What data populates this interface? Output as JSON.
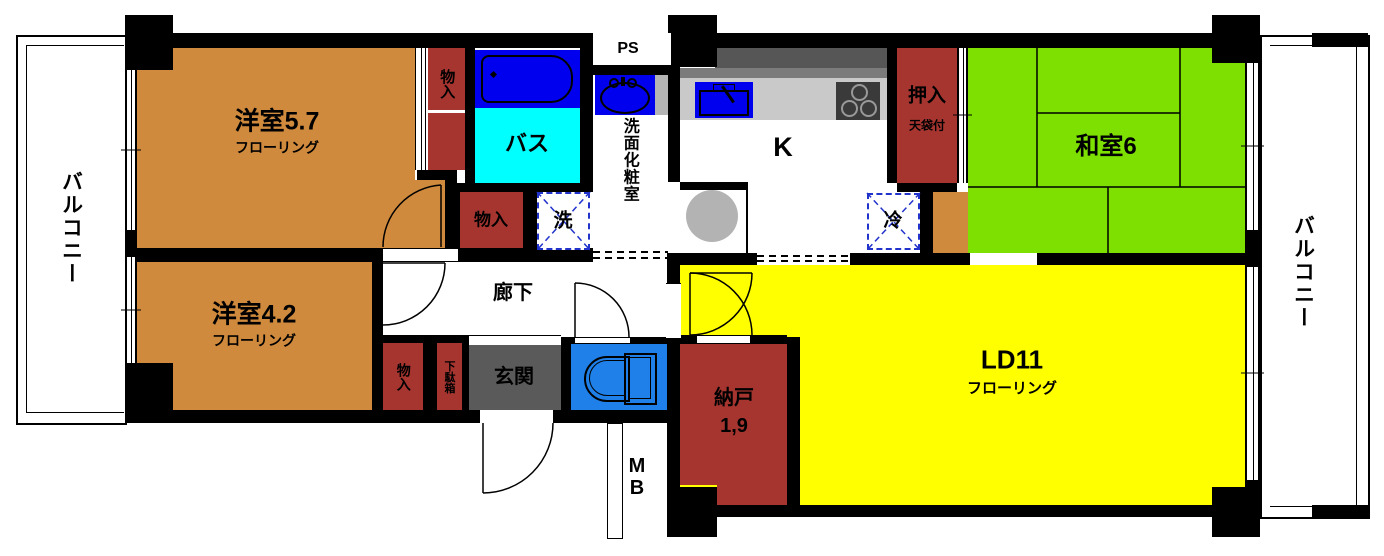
{
  "colors": {
    "wall": "#000000",
    "western_room_orange": "#cf8a3d",
    "closet_dark_red": "#a63530",
    "tatami_green": "#7de000",
    "living_yellow": "#ffff00",
    "bath_floor_cyan": "#00ffff",
    "fixture_blue": "#0000ee",
    "toilet_blue": "#1e80e8",
    "entrance_gray": "#5a5a5a",
    "counter_gray": "#c9c9c9",
    "counter_edge_gray": "#7b7b7b",
    "range_hood_gray": "#565656",
    "equipment_gray": "#b3b3b3",
    "basin_side_gray": "#b5b5b5",
    "appliance_dash_blue": "#2233cc"
  },
  "labels": {
    "balcony_left": "バルコニー",
    "balcony_right": "バルコニー",
    "room57_name": "洋室5.7",
    "room57_floor": "フローリング",
    "room42_name": "洋室4.2",
    "room42_floor": "フローリング",
    "washitsu_name": "和室6",
    "ld_name": "LD11",
    "ld_floor": "フローリング",
    "kitchen": "K",
    "bath": "バス",
    "washroom": "洗面化粧室",
    "ps": "PS",
    "hallway": "廊下",
    "entrance": "玄関",
    "nando_name": "納戸",
    "nando_size": "1,9",
    "oshiire_name": "押入",
    "oshiire_sub": "天袋付",
    "monoire_top": "物入",
    "monoire_mid": "物入",
    "monoire_entrance": "物入",
    "getabako": "下駄箱",
    "washer": "洗",
    "fridge": "冷",
    "meter_box": "MB"
  }
}
